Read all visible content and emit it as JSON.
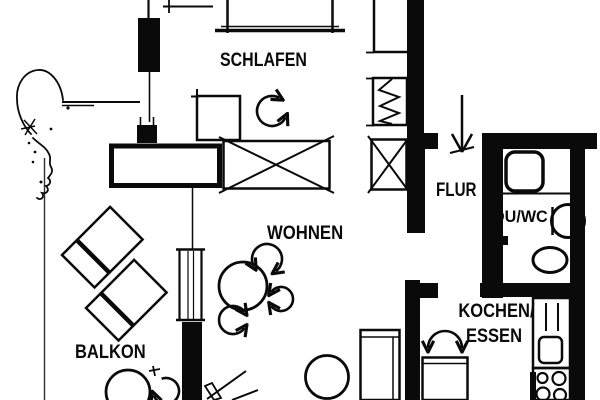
{
  "meta": {
    "type": "apartment-floor-plan"
  },
  "colors": {
    "ink": "#0a0a0a",
    "paper": "#ffffff"
  },
  "labels": {
    "schlafen": "SCHLAFEN",
    "wohnen": "WOHNEN",
    "balkon": "BALKON",
    "flur": "FLUR",
    "duwc": "DU/WC",
    "kochen_line1": "KOCHEN/",
    "kochen_line2": "ESSEN"
  }
}
